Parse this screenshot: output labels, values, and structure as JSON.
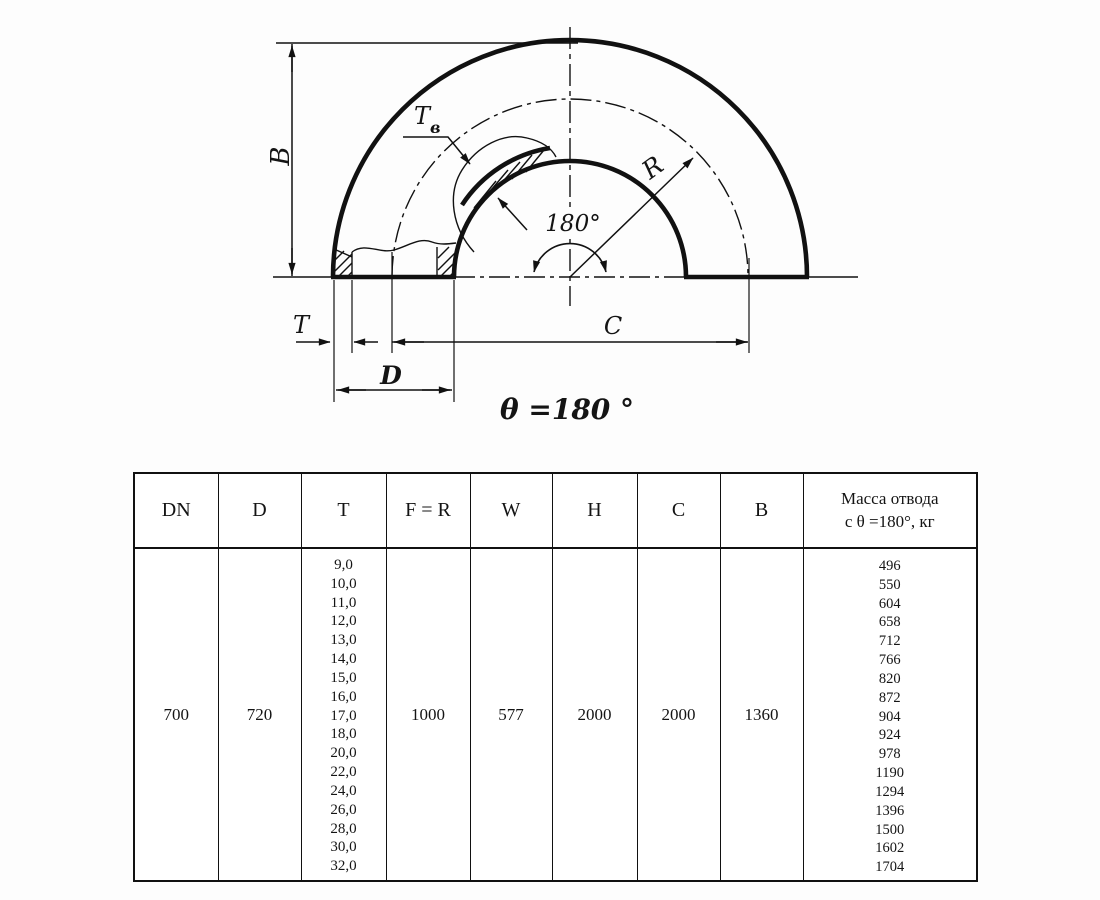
{
  "drawing": {
    "labels": {
      "b": "B",
      "tb_main": "T",
      "tb_sub": "в",
      "r": "R",
      "angle": "180°",
      "t": "T",
      "c": "C",
      "d": "D",
      "theta": "θ =180 °"
    }
  },
  "table": {
    "headers": [
      "DN",
      "D",
      "T",
      "F = R",
      "W",
      "H",
      "C",
      "B"
    ],
    "mass_header_line1": "Масса отвода",
    "mass_header_line2": "с θ =180°, кг",
    "row": {
      "dn": "700",
      "d": "720",
      "f_r": "1000",
      "w": "577",
      "h": "2000",
      "c": "2000",
      "b": "1360"
    },
    "t_values": [
      "9,0",
      "10,0",
      "11,0",
      "12,0",
      "13,0",
      "14,0",
      "15,0",
      "16,0",
      "17,0",
      "18,0",
      "20,0",
      "22,0",
      "24,0",
      "26,0",
      "28,0",
      "30,0",
      "32,0"
    ],
    "mass_values": [
      "496",
      "550",
      "604",
      "658",
      "712",
      "766",
      "820",
      "872",
      "904",
      "924",
      "978",
      "1190",
      "1294",
      "1396",
      "1500",
      "1602",
      "1704"
    ]
  }
}
